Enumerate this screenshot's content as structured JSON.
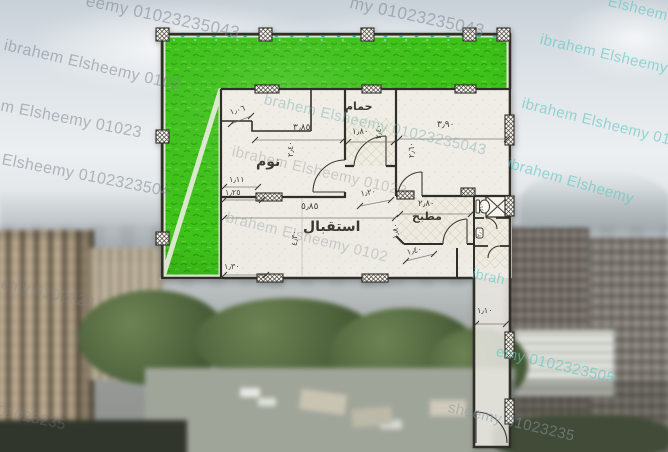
{
  "author_watermark": {
    "name": "ibrahem Elsheemy",
    "phone": "01023235043"
  },
  "watermarks": [
    "eemy 01023235043",
    "my 01023235043",
    "Elsheem",
    "ibrahem Elsheemy 0102",
    "hem Elsheemy 01023",
    "em Elsheemy 0102323504",
    "Elsheemy 0102323",
    "my 01023235",
    "ibrahem Elsheemy 01",
    "ibrahem Elsheemy 010",
    "ibrahem Elsheemy",
    "ibrah",
    "brahem Elsheemy 01023235043",
    "ibrahem Elsheemy 01023",
    "brahem Elsheemy 0102",
    "emy 0102323505",
    "sheemy 01023235"
  ],
  "plan": {
    "rooms": {
      "bedroom": "نوم",
      "bathroom": "حمام",
      "reception": "استقبال",
      "kitchen": "مطبخ"
    },
    "dims": [
      "١٫٠٦",
      "٣٫٨٥",
      "٢٫٤٠",
      "١٫١١",
      "١٫٢٥",
      "١٫٣٠",
      "١٫٨٠",
      "٢٫٤٠",
      "٣٫٩٠",
      "٢٫٦٠",
      "٥٫٨٥",
      "٤٫٣٠",
      "١٫٢٠",
      "٢٫٨٠",
      "١٫٨٠",
      "١٫٤٠",
      "١٫١٠",
      "٠٫٦٠",
      "٢٫٠٠"
    ]
  },
  "colors": {
    "lawn_green": "#3ec31a",
    "watermark_teal": "#5ec6c1",
    "watermark_gray": "#8a939c",
    "fence_dot_teal": "#2aa39b"
  }
}
